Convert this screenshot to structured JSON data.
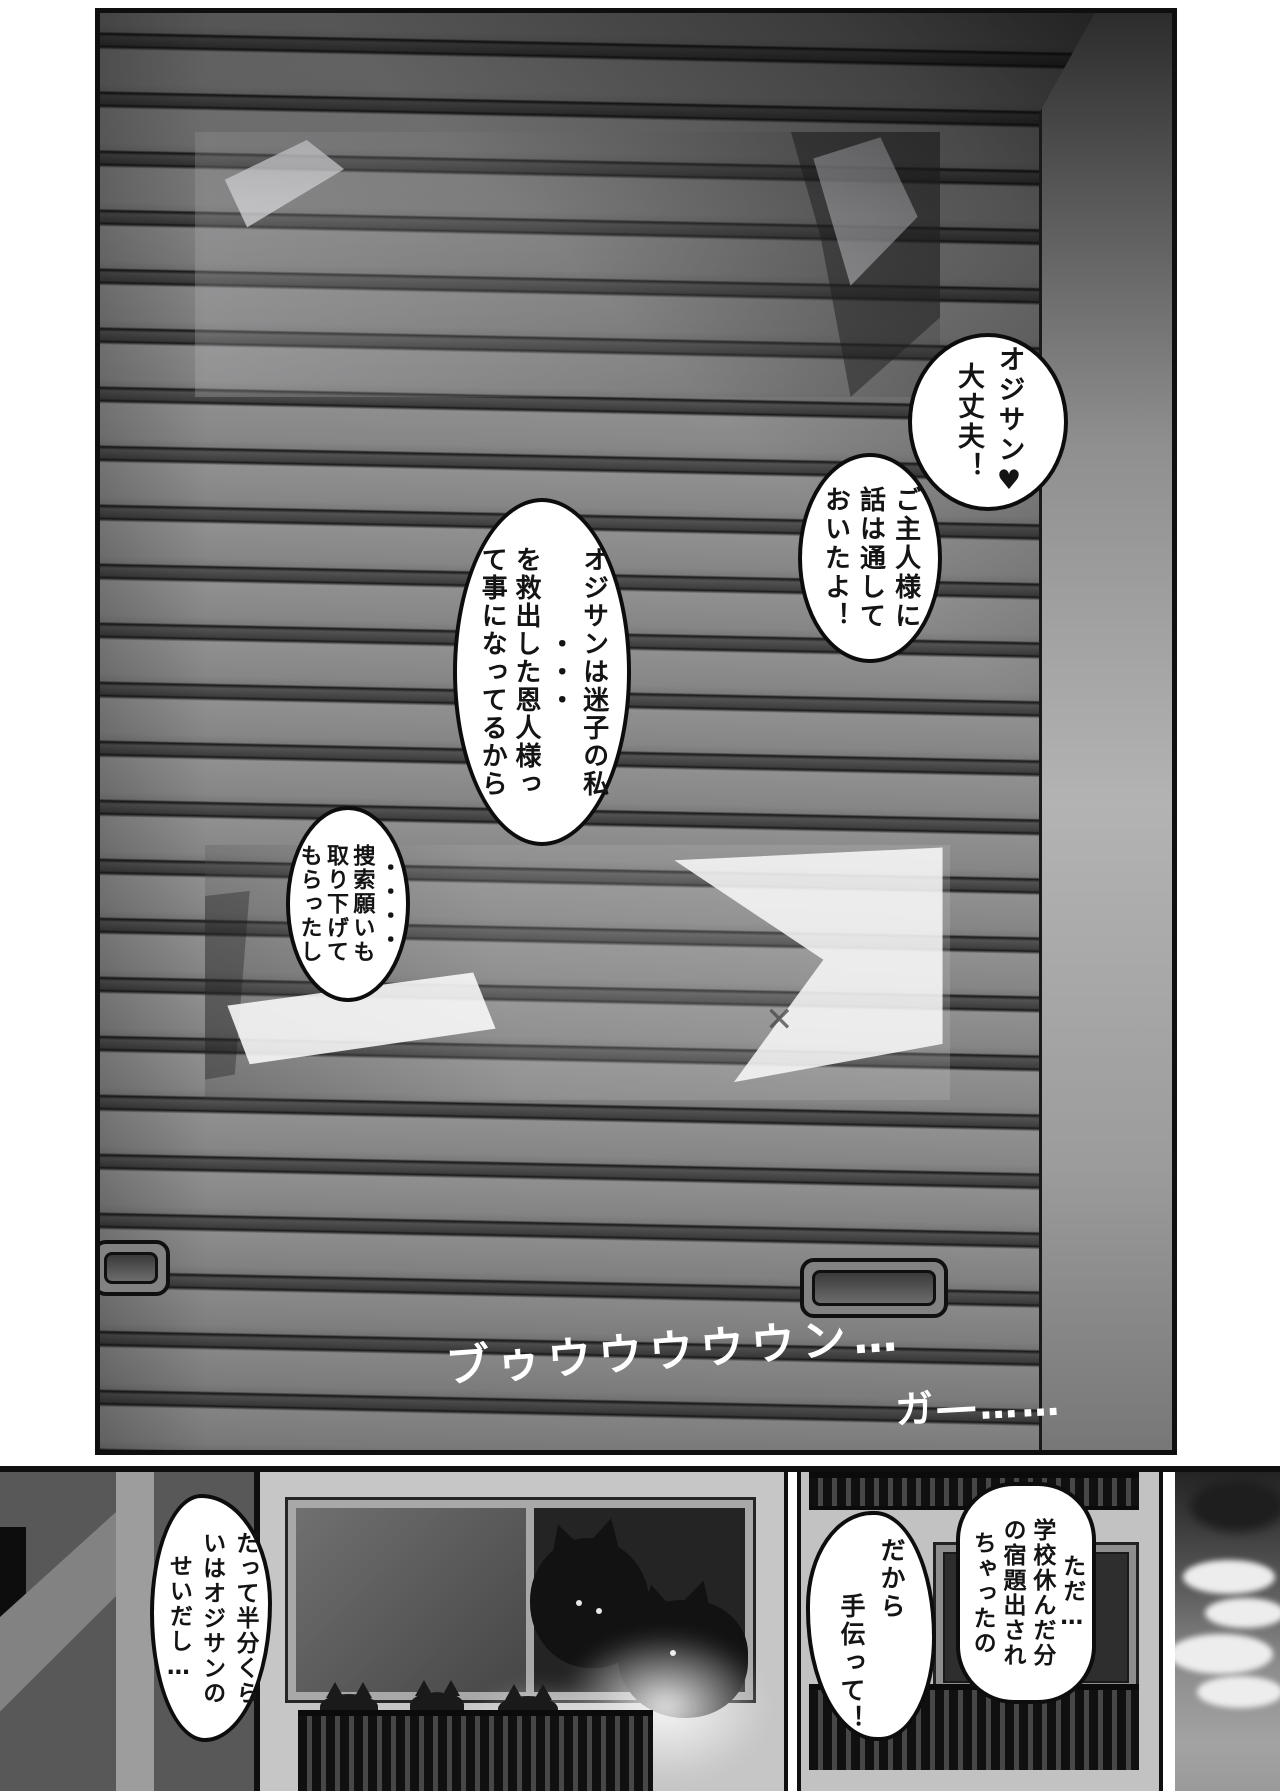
{
  "page_type": "manga-page",
  "colors": {
    "ink": "#0f0f0f",
    "paper": "#ffffff",
    "shutter_gray": "#8a8a8a",
    "slat_band": "#3e3e3e",
    "wall_gray": "#c6c6c6",
    "silhouette_black": "#121212"
  },
  "top_panel": {
    "bubbles": [
      {
        "name": "bubble-ojisan-daijoubu",
        "text": "オジサン♥\n大丈夫！"
      },
      {
        "name": "bubble-goshujinsama",
        "text": "ご主人様に\n話は通して\nおいたよ！"
      },
      {
        "name": "bubble-maigo",
        "text": "オジサンは迷子の私\n・・・\nを救出した恩人様っ\nて事になってるから"
      },
      {
        "name": "bubble-sousaku-negai",
        "text": "・・・・\n捜索願いも\n取り下げて\nもらったし"
      }
    ],
    "sfx": [
      {
        "name": "sfx-engine-rumble",
        "text": "ブゥウウウウウン…"
      },
      {
        "name": "sfx-gaa",
        "text": "ガ―……"
      }
    ]
  },
  "bottom_strip": {
    "bubbles": [
      {
        "name": "bubble-datte-hanbun",
        "text": "だって半分くら\nいはオジサンの\nせいだし…"
      },
      {
        "name": "bubble-tetsudatte",
        "text": "だから\n　　手伝って！"
      },
      {
        "name": "bubble-shukudai",
        "text": "ただ…\n学校休んだ分\nの宿題出され\nちゃったの"
      }
    ]
  },
  "icons": {
    "scratch_x": "✕"
  }
}
